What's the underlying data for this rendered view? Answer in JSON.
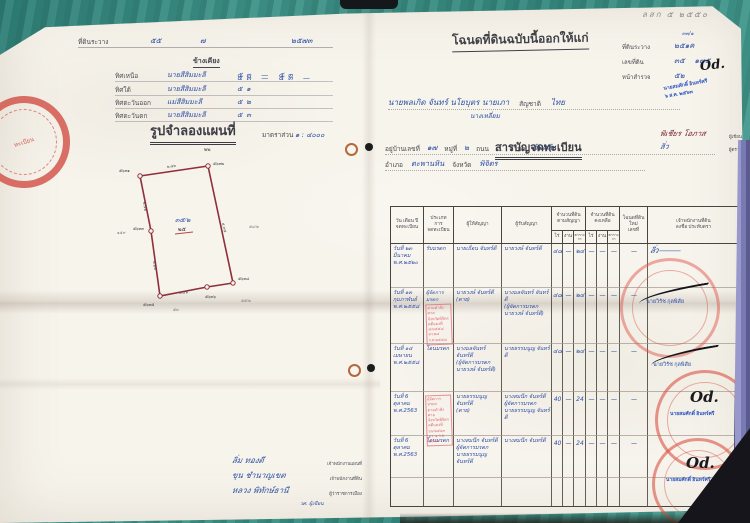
{
  "pencil_note": "ลสก ๕ ๒๕๕๐",
  "left_page": {
    "header_line": {
      "label": "ที่ดินระวาง",
      "v1": "๕๕",
      "v2": "๗",
      "v3": "๒๕๗๓"
    },
    "neighbors": {
      "heading": "ข้างเคียง",
      "rows": [
        {
          "dir": "ทิศเหนือ",
          "name": "นายสีสิมมะลี",
          "nums": "๕๓ — ๕๓"
        },
        {
          "dir": "ทิศใต้",
          "name": "นายสีสิมมะลี",
          "nums": "๕๓ — ๕๓ — ๕๑"
        },
        {
          "dir": "ทิศตะวันออก",
          "name": "แม่สีสิมมะลี",
          "nums": "๕๒"
        },
        {
          "dir": "ทิศตะวันตก",
          "name": "นายสีสิมมะลี",
          "nums": "๕๓"
        }
      ]
    },
    "map": {
      "heading": "รูปจำลองแผนที่",
      "scale_label": "มาตราส่วน",
      "scale_value": "๑ : ๔๐๐๐",
      "mark": "๒๒",
      "parcel_no": "๓๕/๒",
      "parcel_no_old": "๒๕",
      "corner_labels": [
        "๕๖๓๑",
        "๕๖๓๒",
        "๕๖๓๓",
        "๕๖๓๔",
        "๕๖๓๕",
        "๕๖๓๖"
      ],
      "edge_labels": {
        "top": "๒.๗๖",
        "right": "๔.๙๕",
        "bottom": "๒.๔๑",
        "left_lower": "๒.๒๒",
        "left_upper": "๒.๕๒"
      },
      "outside_marks": [
        "๑๕๙",
        "๕๔/๒",
        "๕๕/๒",
        "๕๓"
      ]
    },
    "stamp_left_text": "ทะเบียน",
    "signatures": [
      {
        "script": "ลิ่ม ทองดี",
        "caption": "เจ้าพนักงานแผนที่"
      },
      {
        "script": "ขุน ชำนาญเขต",
        "caption": "เจ้าพนักงานที่ดิน"
      },
      {
        "script": "หลวง พิทักษ์ธานี",
        "caption": "ผู้ว่าราชการเมือง"
      }
    ],
    "written_by": "วศ. ผู้เขียน"
  },
  "right_page": {
    "title": "โฉนดที่ดินฉบับนี้ออกให้แก่",
    "fields": [
      {
        "label": "ที่ดินระวาง",
        "value": "๒๕๑ค",
        "extra": "๓๓/๑"
      },
      {
        "label": "เลขที่ดิน",
        "value": "๓๕    ๑๗๕"
      },
      {
        "label": "หน้าสำรวจ",
        "value": "๕๒"
      }
    ],
    "officer_monogram": "Od.",
    "blue_stamp": {
      "line1": "นายสมศักดิ์ อินทร์ศรี",
      "line2": "๖ ส.ค. ๒๕๖๓"
    },
    "grantee": {
      "names": "นายพลเกิด จันทร์ นโยบุตร นายเภา",
      "extra": "นางเหลี่ยม",
      "nat_label": "สัญชาติ",
      "nat": "ไทย"
    },
    "address": {
      "l1_label1": "อยู่บ้านเลขที่",
      "l1_v1": "๑๗",
      "l1_label2": "หมู่ที่",
      "l1_v2": "๒",
      "l1_label3": "ถนน",
      "l1_dash": "—",
      "l1_label4": "ตำบล",
      "l1_v4": "ต้นคลุ้ง",
      "l2_label1": "อำเภอ",
      "l2_v1": "ตะพานหิน",
      "l2_label2": "จังหวัด",
      "l2_v2": "พิจิตร"
    },
    "registry": {
      "heading": "สารบัญจดทะเบียน",
      "side_sigs": [
        {
          "script": "พิเชียร โอภาส",
          "caption": "ผู้เขียน"
        },
        {
          "script": "ลิ่ว",
          "caption": "ผู้ตรวจ"
        }
      ],
      "header": {
        "c1": "วัน เดือน ปี\nจดทะเบียน",
        "c2": "ประเภท\nการ\nจดทะเบียน",
        "c3": "ผู้ให้สัญญา",
        "c4": "ผู้รับสัญญา",
        "c5": "จำนวนที่ดิน\nตามสัญญา",
        "c6": "จำนวนที่ดิน\nคงเหลือ",
        "c7": "โฉนดที่ดินใหม่\nเลขที่",
        "c8": "เจ้าพนักงานที่ดิน\nลงชื่อ ประทับตรา",
        "sub_rai": "ไร่",
        "sub_ngan": "งาน",
        "sub_wa": "ตาราง\nวา"
      },
      "rows": [
        {
          "date": "วันที่ ๒๓\nมีนาคม\nพ.ศ.๒๕๒๐",
          "type": "รับมรดก",
          "stamp": "",
          "giver": "นายเถื่อน จันทร์ดี",
          "receiver": "นายวงษ์ จันทร์ดี",
          "r1": "๔๘",
          "n1": "—",
          "w1": "๒๔",
          "r2": "—",
          "n2": "—",
          "w2": "—",
          "deed": "—",
          "officer": "ลิ่ว ———"
        },
        {
          "date": "วันที่ ๑๓\nกุมภาพันธ์\nพ.ศ.๒๕๕๘",
          "type": "ผู้จัดการ\nมรดก",
          "stamp": "ตามคำสั่งศาล\nจังหวัดพิจิตร\nคดีแดงที่ ๘/๒๕๕๘\nลว.๒๔ ก.พ.๒๕๕๘",
          "giver": "นายวงษ์ จันทร์ดี\n(ตาย)",
          "receiver": "นางมลจันทร์ จันทร์ดี\n(ผู้จัดการมรดก\nนายวงษ์ จันทร์ดี)",
          "r1": "๔๘",
          "n1": "—",
          "w1": "๒๔",
          "r2": "—",
          "n2": "—",
          "w2": "—",
          "deed": "—",
          "officer": "นายวิรัช กุลพิสัย"
        },
        {
          "date": "วันที่ ๑๔\nเมษายน\nพ.ศ.๒๕๕๘",
          "type": "โอนมรดก",
          "stamp": "",
          "giver": "นางมลจันทร์ จันทร์ดี\n(ผู้จัดการมรดก\nนายวงษ์ จันทร์ดี)",
          "receiver": "นายธรรมนูญ จันทร์ดี",
          "r1": "๔๘",
          "n1": "—",
          "w1": "๒๔",
          "r2": "—",
          "n2": "—",
          "w2": "—",
          "deed": "—",
          "officer": "นายวิรัช กุลพิสัย"
        },
        {
          "date": "วันที่ 6\nตุลาคม\nพ.ศ.2563",
          "type": "",
          "stamp": "ผู้จัดการมรดก\nตามคำสั่งศาล\nจังหวัดพิจิตร\nคดีแดงที่ ๖๖/๒๕๖๓\nลว. ๑ ก.ย. ๒๕๖๓",
          "giver": "นายธรรมนูญ จันทร์ดี\n(ตาย)",
          "receiver": "นางสมนึก จันทร์ดี\nผู้จัดการมรดก\nนายธรรมนูญ จันทร์ดี",
          "r1": "40",
          "n1": "—",
          "w1": "24",
          "r2": "—",
          "n2": "—",
          "w2": "—",
          "deed": "—",
          "officer": "นายสมศักดิ์ อินทร์ศรี"
        },
        {
          "date": "วันที่ 6\nตุลาคม\nพ.ศ.2563",
          "type": "โอนมรดก",
          "stamp": "",
          "giver": "นางสมนึก จันทร์ดี\nผู้จัดการมรดก\nนายธรรมนูญ จันทร์ดี",
          "receiver": "นางสมนึก จันทร์ดี",
          "r1": "40",
          "n1": "—",
          "w1": "24",
          "r2": "—",
          "n2": "—",
          "w2": "—",
          "deed": "—",
          "officer": "นายสมศักดิ์ อินทร์ศรี"
        }
      ]
    }
  }
}
